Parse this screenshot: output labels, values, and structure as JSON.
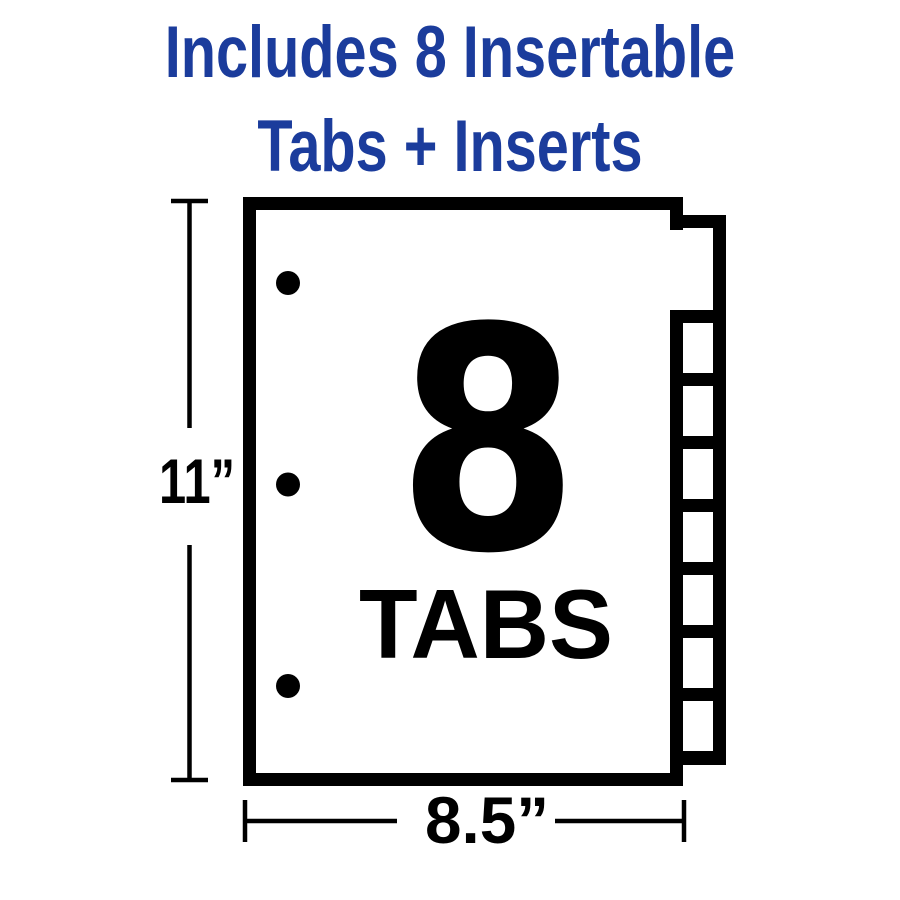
{
  "colors": {
    "background": "#ffffff",
    "heading_blue": "#1b3c9c",
    "diagram_ink": "#000000",
    "paper": "#ffffff"
  },
  "heading": {
    "line1": "Includes 8 Insertable",
    "line2": "Tabs + Inserts"
  },
  "diagram": {
    "tab_count": 8,
    "hole_count": 3,
    "sheet": {
      "big_number": "8",
      "big_word": "TABS"
    },
    "dimensions": {
      "height_label": "11”",
      "width_label": "8.5”"
    }
  }
}
